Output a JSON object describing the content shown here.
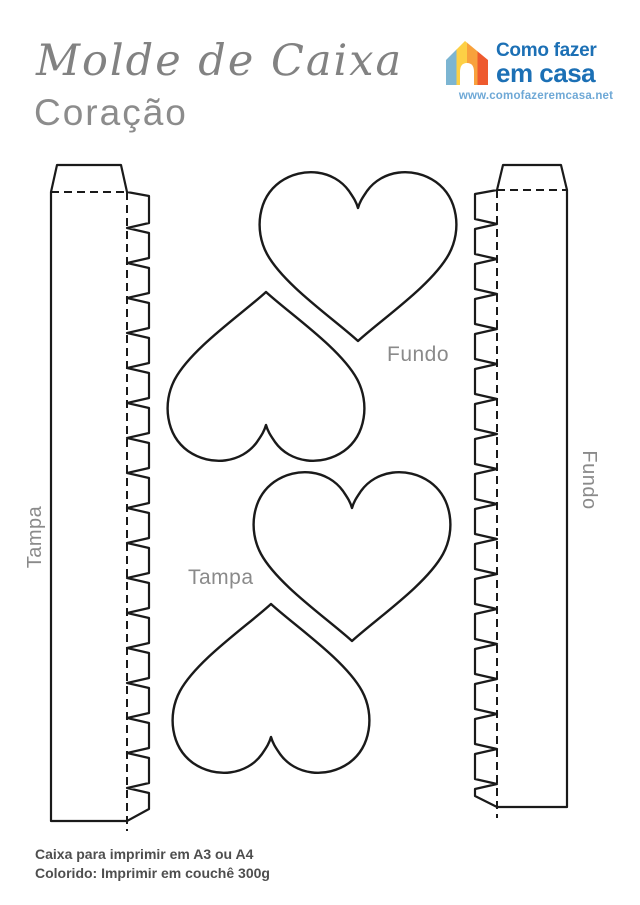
{
  "header": {
    "title_script": "Molde de Caixa",
    "title_sub": "Coração"
  },
  "logo": {
    "name_line1": "Como fazer",
    "name_line2": "em casa",
    "url": "www.comofazeremcasa.net",
    "brand_blue": "#1C70B5",
    "url_blue": "#6EA8D6",
    "house_colors": [
      "#7CB5D2",
      "#FDD045",
      "#F8A13C",
      "#EE5A2E"
    ]
  },
  "pattern": {
    "line_color": "#1A1A1A",
    "label_color": "#8A8A8A",
    "strip_left_label": "Tampa",
    "strip_right_label": "Fundo",
    "hearts_top_label": "Fundo",
    "hearts_bottom_label": "Tampa"
  },
  "footer": {
    "line1": "Caixa para imprimir em A3 ou A4",
    "line2": "Colorido: Imprimir em couchê 300g"
  }
}
